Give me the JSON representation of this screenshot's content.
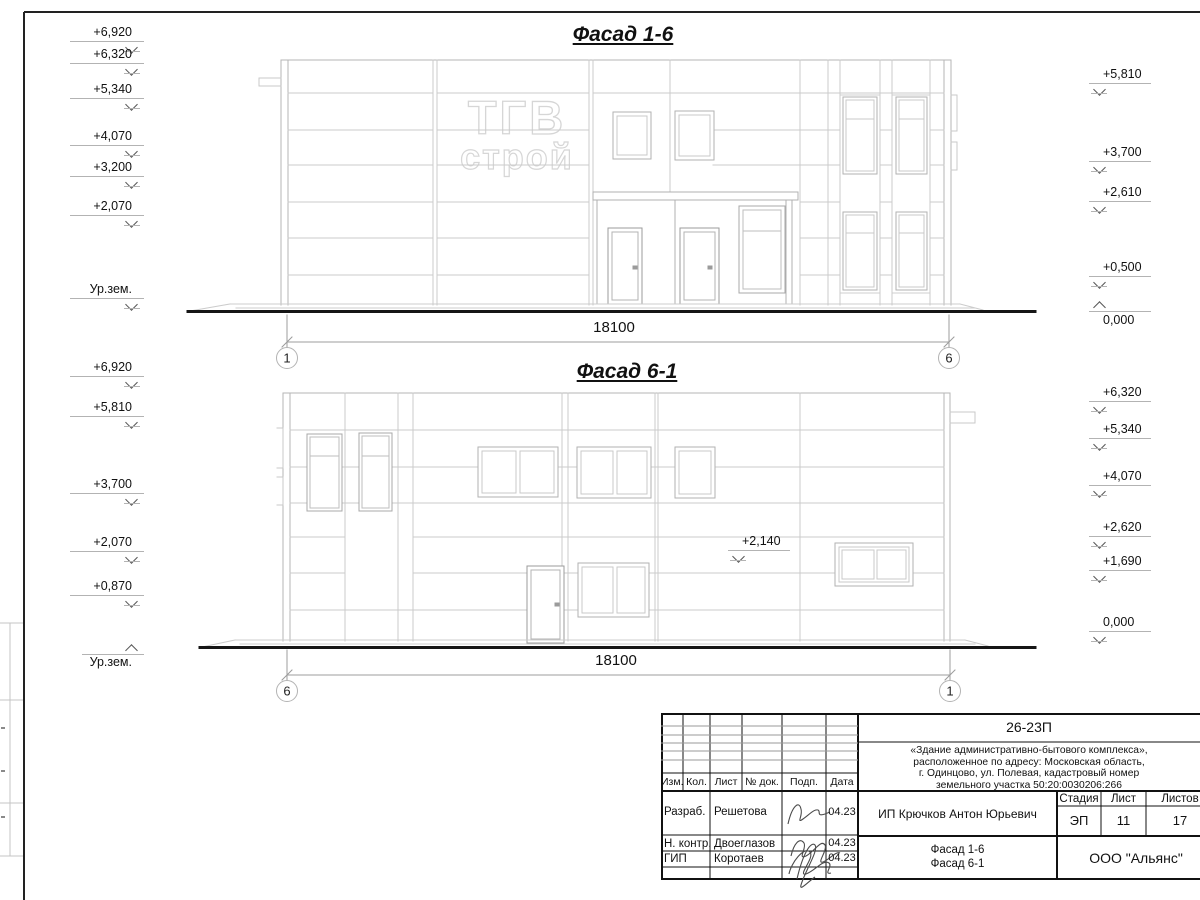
{
  "facade1": {
    "title": "Фасад 1-6",
    "logo_line1": "ТГВ",
    "logo_line2": "строй",
    "left_marks": [
      "+6,920",
      "+6,320",
      "+5,340",
      "+4,070",
      "+3,200",
      "+2,070",
      "Ур.зем."
    ],
    "right_marks": [
      "+5,810",
      "+3,700",
      "+2,610",
      "+0,500",
      "0,000"
    ],
    "dimension": "18100",
    "axis_left": "1",
    "axis_right": "6"
  },
  "facade2": {
    "title": "Фасад 6-1",
    "left_marks": [
      "+6,920",
      "+5,810",
      "+3,700",
      "+2,070",
      "+0,870",
      "Ур.зем."
    ],
    "right_marks": [
      "+6,320",
      "+5,340",
      "+4,070",
      "+2,620",
      "+1,690",
      "0,000"
    ],
    "level_annotation": "+2,140",
    "dimension": "18100",
    "axis_left": "6",
    "axis_right": "1"
  },
  "title_block": {
    "code": "26-23П",
    "desc_line1": "«Здание административно-бытового комплекса»,",
    "desc_line2": "расположенное по адресу: Московская область,",
    "desc_line3": "г. Одинцово, ул. Полевая, кадастровый номер",
    "desc_line4": "земельного участка 50:20:0030206:266",
    "col_izm": "Изм.",
    "col_kol": "Кол.",
    "col_list": "Лист",
    "col_doc": "№ док.",
    "col_podp": "Подп.",
    "col_data": "Дата",
    "row1_role": "Разраб.",
    "row1_name": "Решетова",
    "row1_date": "04.23",
    "row2_role": "Н. контр.",
    "row2_name": "Двоеглазов",
    "row2_date": "04.23",
    "row3_role": "ГИП",
    "row3_name": "Коротаев",
    "row3_date": "04.23",
    "client": "ИП Крючков Антон Юрьевич",
    "stage_label": "Стадия",
    "stage": "ЭП",
    "sheet_label": "Лист",
    "sheet": "11",
    "sheets_label": "Листов",
    "sheets": "17",
    "content_line1": "Фасад 1-6",
    "content_line2": "Фасад 6-1",
    "organization": "ООО \"Альянс\""
  }
}
